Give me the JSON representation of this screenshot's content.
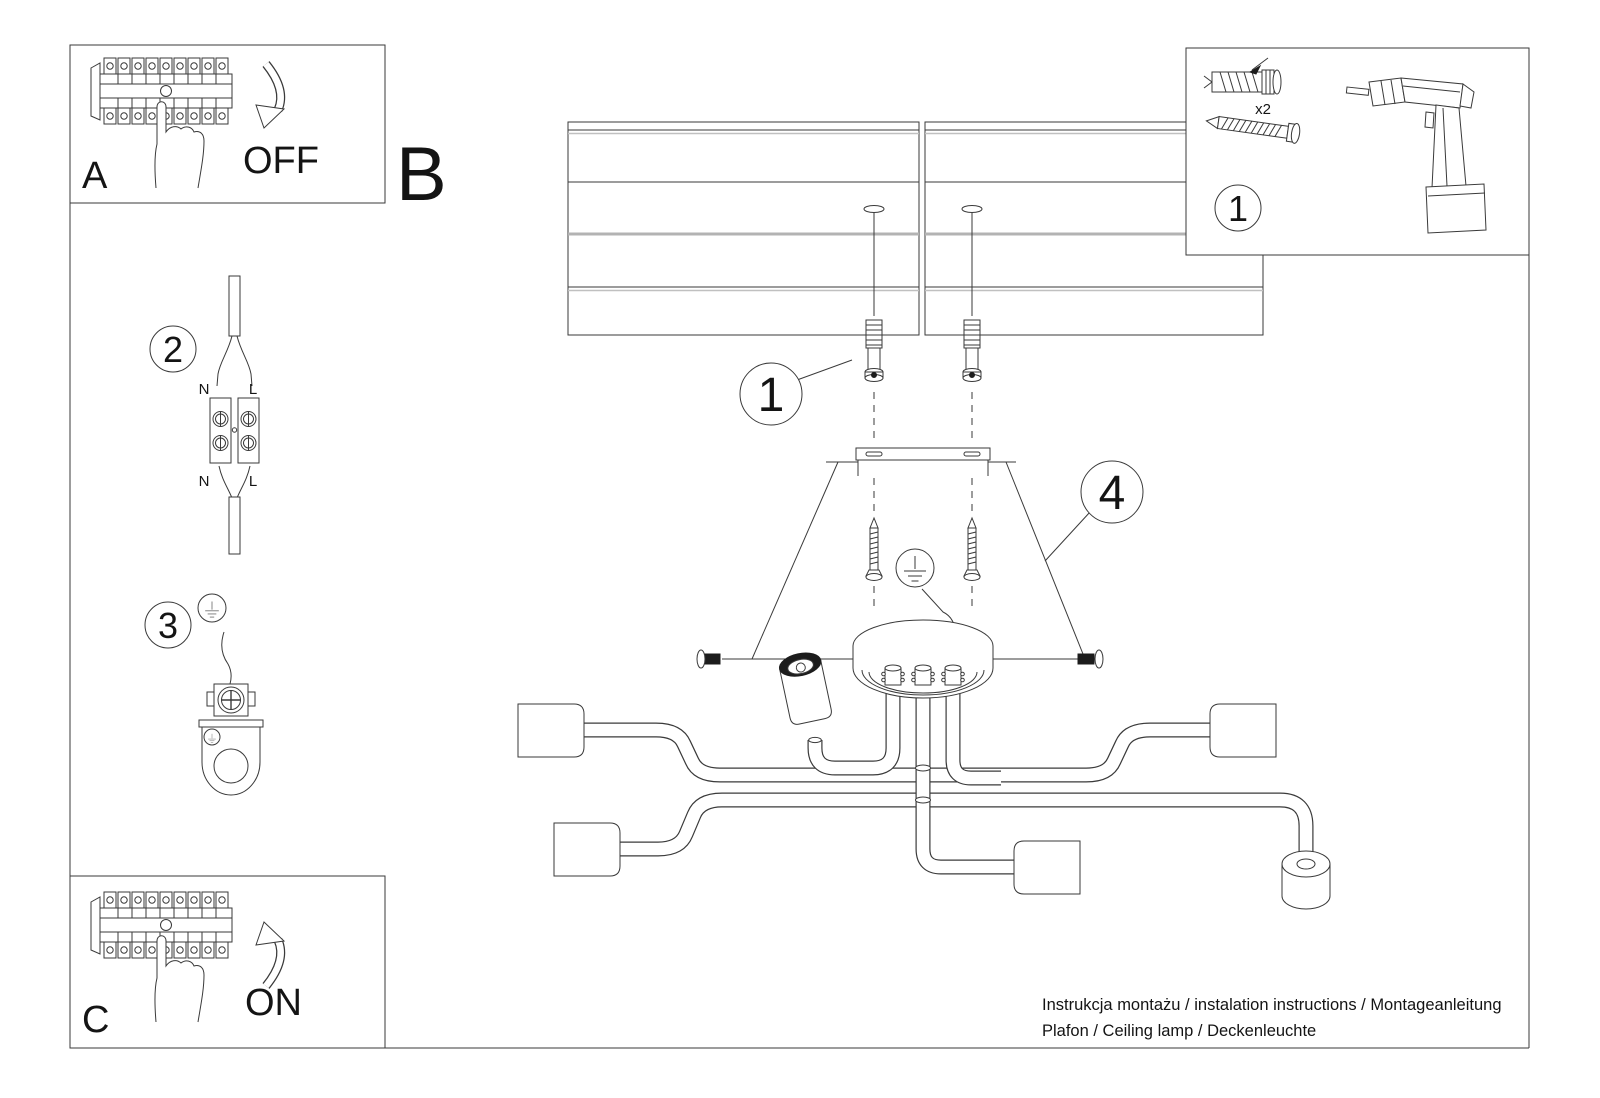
{
  "labels": {
    "a": "A",
    "b": "B",
    "c": "C"
  },
  "breaker_panels": {
    "off_label": "OFF",
    "on_label": "ON"
  },
  "parts_panel": {
    "step_number": "1",
    "dowel_quantity": "x2"
  },
  "steps": {
    "step1": "1",
    "step2": "2",
    "step3": "3",
    "step4": "4"
  },
  "wiring": {
    "neutral": "N",
    "live": "L"
  },
  "footer": {
    "line1": "Instrukcja montażu / instalation instructions / Montageanleitung",
    "line2": "Plafon / Ceiling lamp / Deckenleuchte"
  },
  "colors": {
    "line": "#3a3a3a",
    "muted_line": "#b3b3b3",
    "paper": "#ffffff"
  }
}
